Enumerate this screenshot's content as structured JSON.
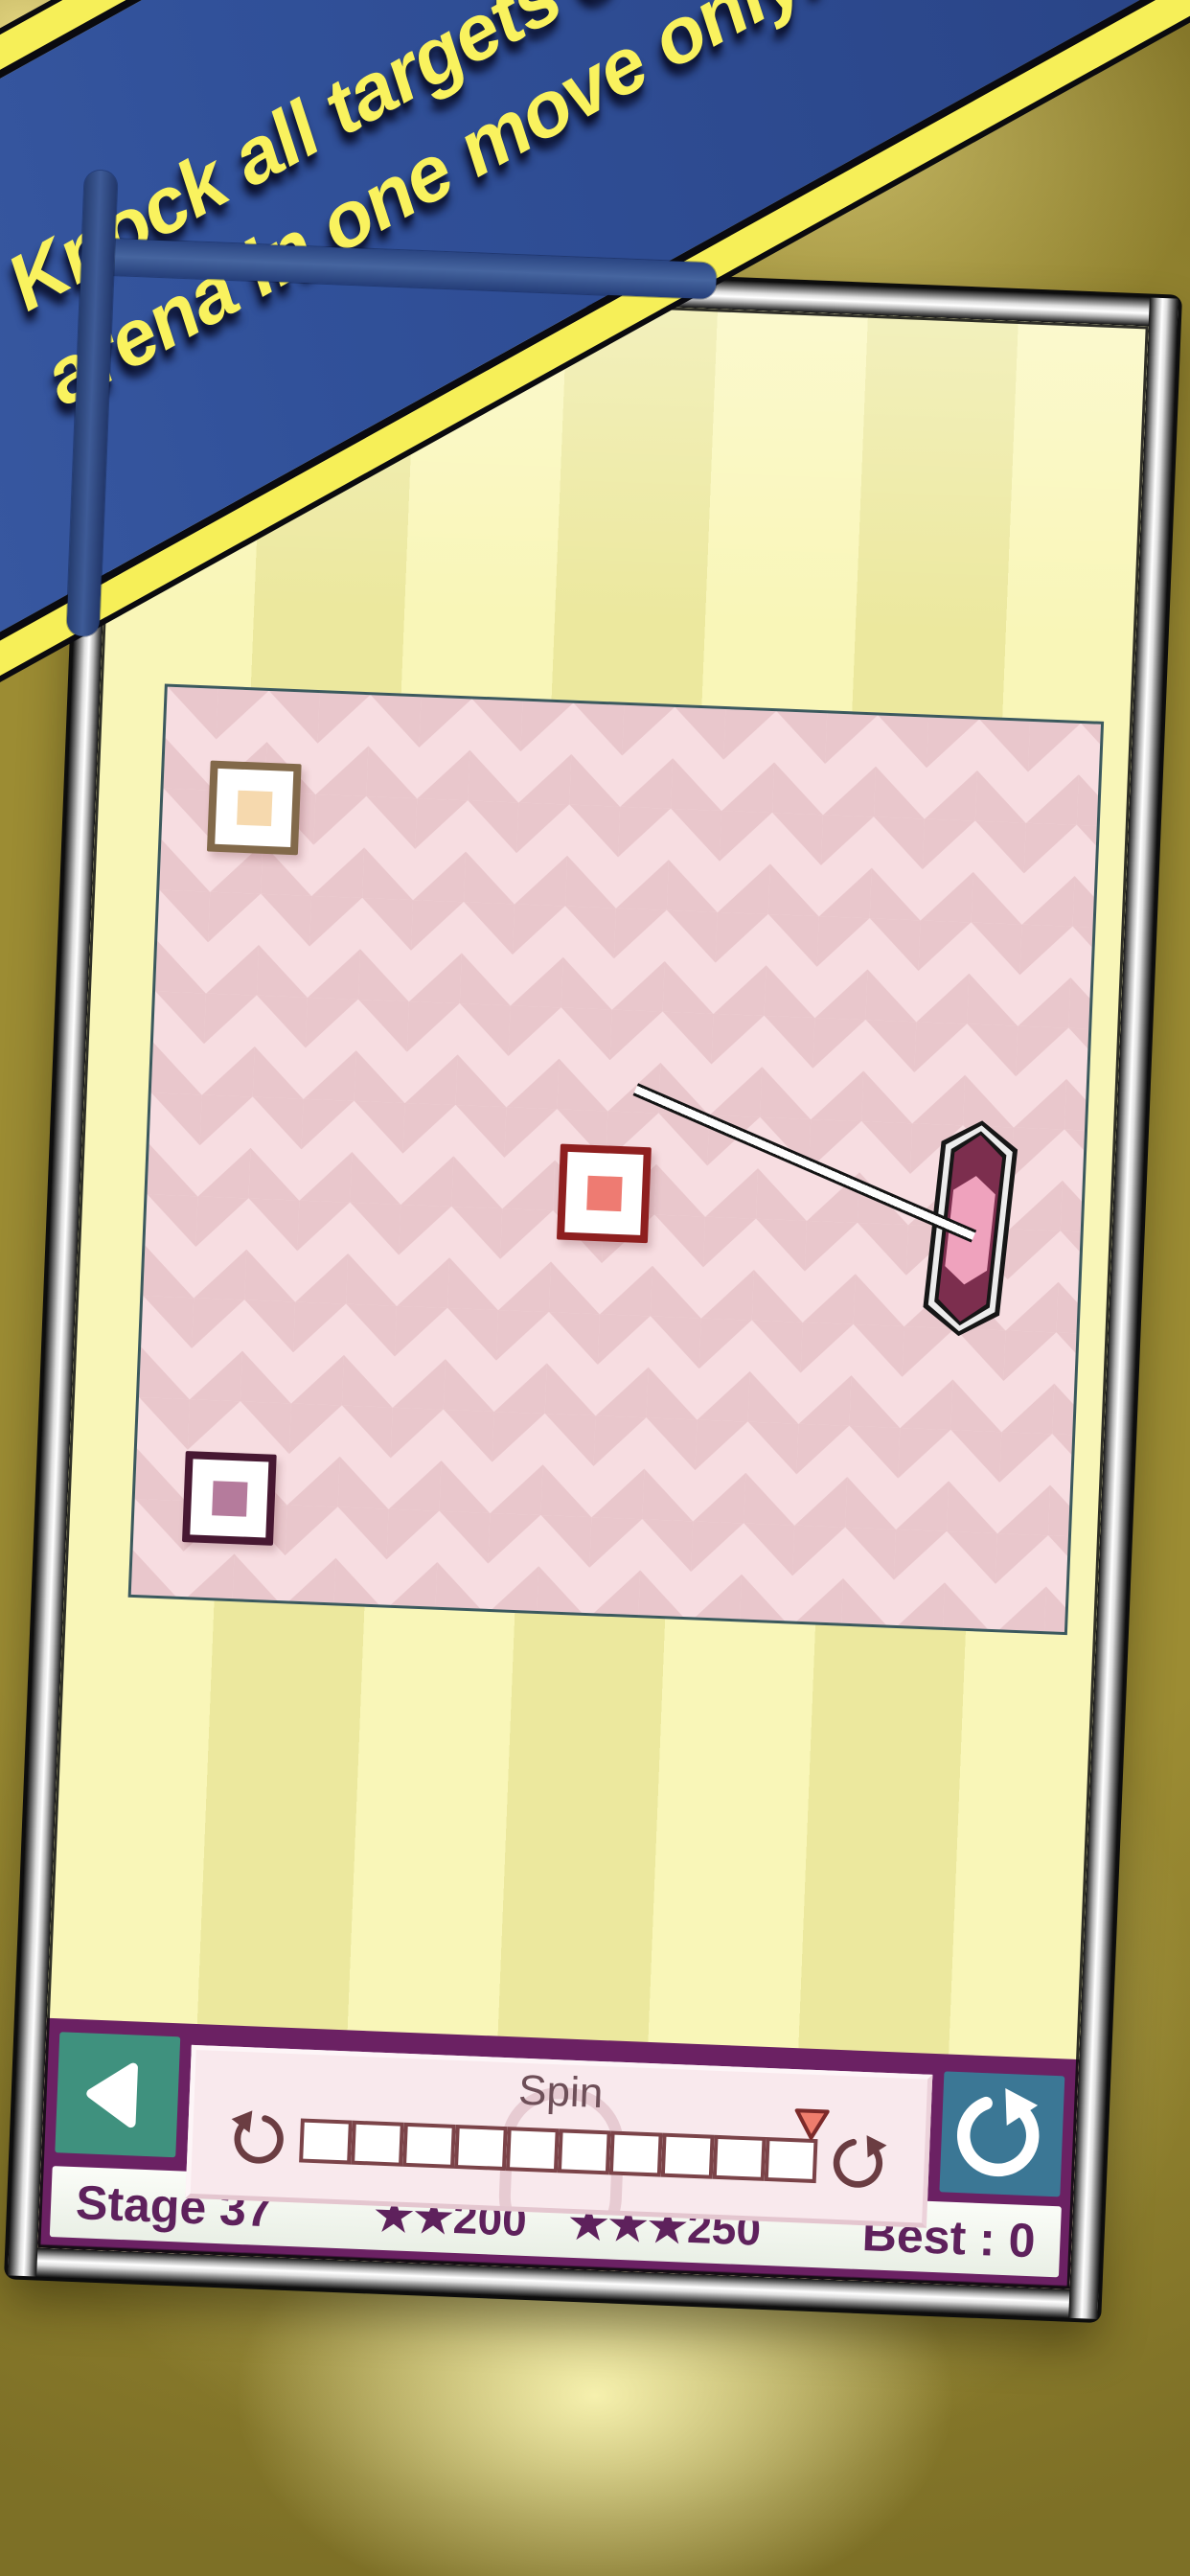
{
  "banner": {
    "line1": "Knock all targets out of",
    "line2": "arena in one move only!"
  },
  "spin": {
    "label": "Spin",
    "cells": 10,
    "marker_position": "right-end"
  },
  "status": {
    "stage": "Stage 37",
    "goal2_stars": "★★",
    "goal2_value": "200",
    "goal3_stars": "★★★",
    "goal3_value": "250",
    "best": "Best : 0"
  },
  "icons": {
    "back": "back-triangle-icon",
    "restart": "rotate-cw-icon",
    "spin_left": "rotate-ccw-icon",
    "spin_right": "rotate-cw-icon",
    "marker": "down-triangle-marker"
  },
  "colors": {
    "background_olive": "#9c8c33",
    "glow_yellow": "#faf5ad",
    "banner_blue": "#31519a",
    "banner_yellow": "#f6ef58",
    "banner_text": "#f9f25e",
    "wallpaper_light": "#f9f6b8",
    "wallpaper_dark": "#ece89e",
    "arena_light_pink": "#f7dde1",
    "arena_dark_pink": "#e9c7cc",
    "ui_purple": "#6b2163",
    "back_button_teal": "#3f917e",
    "restart_button_blue": "#3b7795",
    "spin_panel_pink": "#f9e9ed",
    "slider_border": "#7b4348",
    "marker_red": "#ef7d6d",
    "status_text_purple": "#5e215c",
    "target1_border": "#82694a",
    "target1_core": "#f6d9ae",
    "target2_border": "#8e1f1f",
    "target2_core": "#ee7b72",
    "target3_border": "#471832",
    "target3_core": "#b57b9c",
    "mallet_body": "#7c2e4e",
    "mallet_inner": "#efa2bd"
  }
}
